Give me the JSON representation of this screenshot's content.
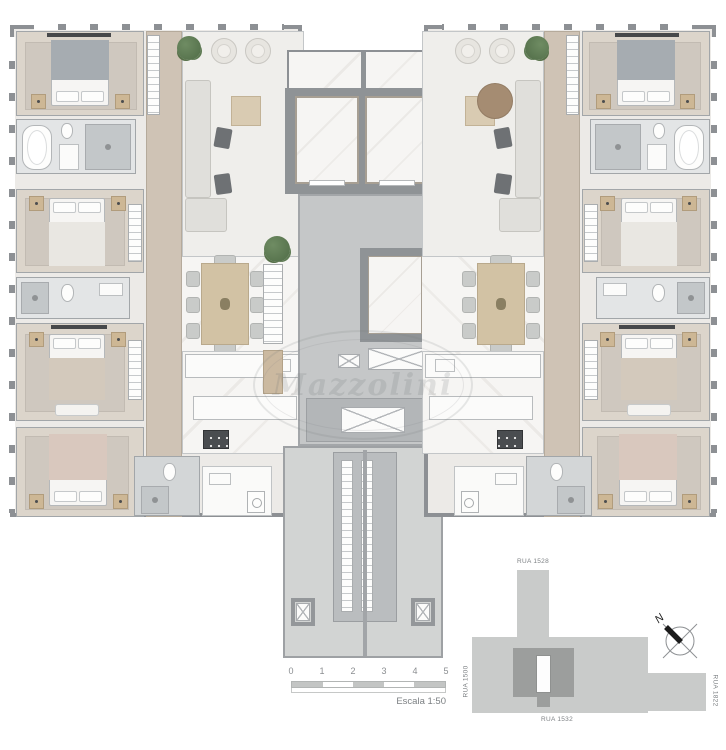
{
  "plan": {
    "watermark_text": "Mazzolini",
    "north_label": "N"
  },
  "scale_bar": {
    "ticks": [
      "0",
      "1",
      "2",
      "3",
      "4",
      "5"
    ],
    "label": "Escala 1:50"
  },
  "site_map": {
    "streets": {
      "top": "RUA 1528",
      "left": "RUA 1500",
      "bottom": "RUA 1532",
      "right": "RUA 1822"
    }
  },
  "colors": {
    "wall": "#8d9094",
    "floor_light": "#eceae7",
    "wood_floor": "#cfc3b5",
    "marble": "#f6f5f3",
    "bedroom_floor": "#dcd5cb",
    "rug": "#cfc8bf",
    "tan_accent": "#cdb795",
    "plant_green": "#5d7a52",
    "site_light": "#c9cbca",
    "site_dark": "#9c9e9d"
  }
}
